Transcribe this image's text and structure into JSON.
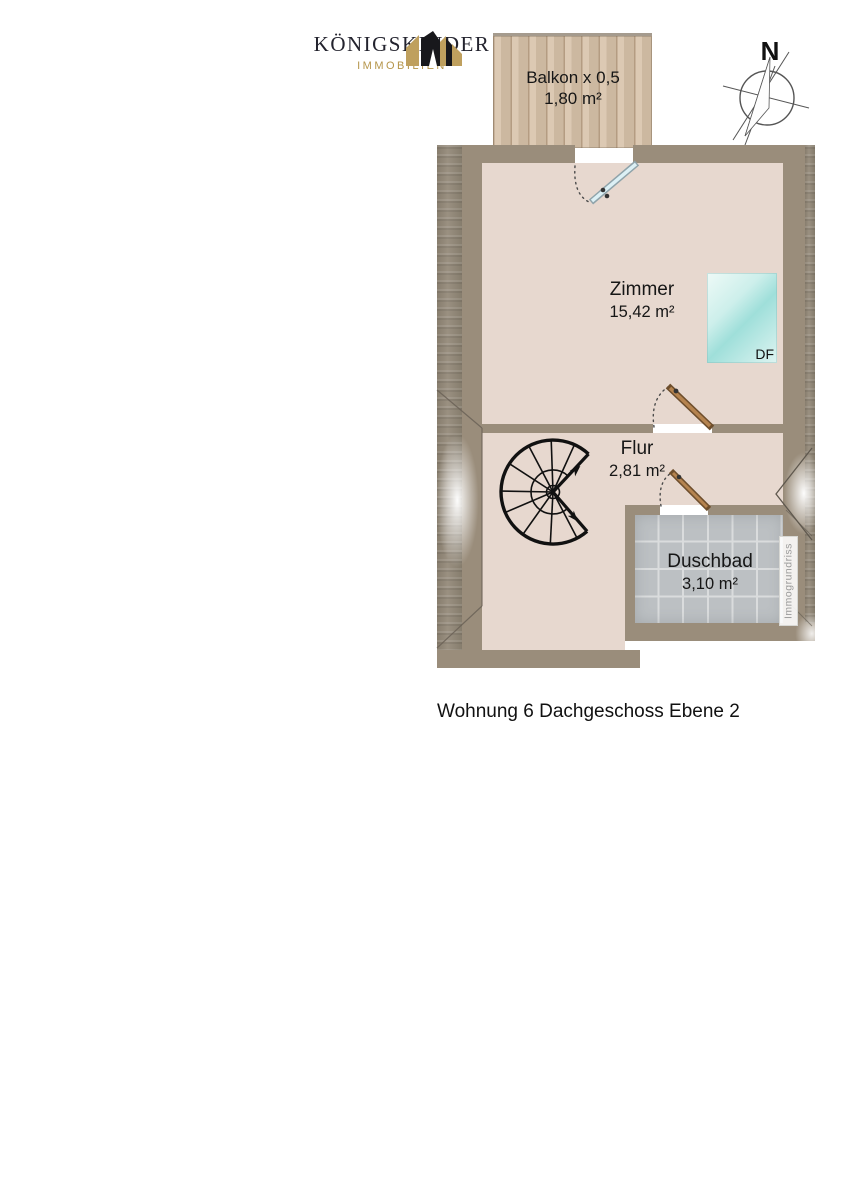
{
  "caption": "Wohnung 6 Dachgeschoss Ebene 2",
  "logo": {
    "title": "KÖNIGSKINDER",
    "subtitle": "IMMOBILIEN"
  },
  "compass": {
    "north": "N"
  },
  "watermark": "Immogrundriss",
  "rooms": {
    "balkon": {
      "name": "Balkon x 0,5",
      "area": "1,80 m²"
    },
    "zimmer": {
      "name": "Zimmer",
      "area": "15,42 m²"
    },
    "flur": {
      "name": "Flur",
      "area": "2,81 m²"
    },
    "duschbad": {
      "name": "Duschbad",
      "area": "3,10 m²"
    }
  },
  "skylight": {
    "label": "DF"
  },
  "colors": {
    "wall": "#9a8d7b",
    "floor": "#e7d8cf",
    "wood": "#d7c2a9",
    "wood-line": "#b49c82",
    "tile": "#bcc0c3",
    "grout": "#dadcdd",
    "door-wood": "#b5834f",
    "door-wood-dark": "#6e4e2c",
    "glass": "#dcf0f5",
    "glass-dark": "#8fa3aa",
    "gold": "#bfa05e",
    "gold-text": "#b5954a",
    "navy": "#23232e"
  }
}
